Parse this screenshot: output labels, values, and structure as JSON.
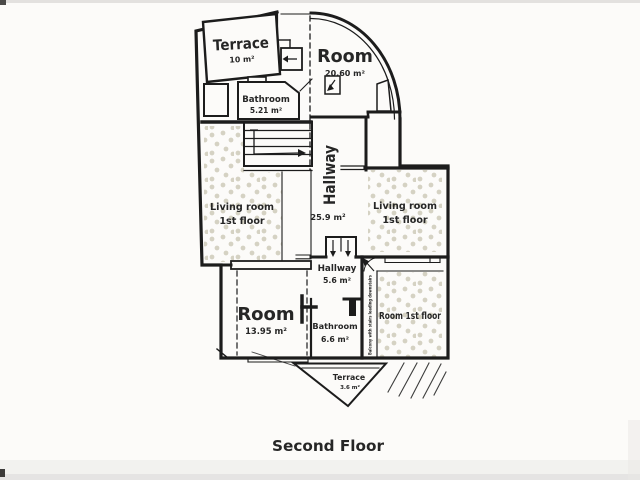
{
  "page": {
    "title": "Second Floor"
  },
  "colors": {
    "wall": "#1c1c1c",
    "dot_fill": "#d5d2c3",
    "paper": "#fcfbf9",
    "text": "#262626"
  },
  "rooms": {
    "terrace_top": {
      "label": "Terrace",
      "area": "10 m²"
    },
    "bathroom_top": {
      "label": "Bathroom",
      "area": "5.21 m²"
    },
    "room_round": {
      "label": "Room",
      "area": "20.60 m²"
    },
    "hallway_main": {
      "label": "Hallway",
      "area": "25.9 m²"
    },
    "living_room_left": {
      "label": "Living room",
      "sublabel": "1st floor"
    },
    "living_room_right": {
      "label": "Living room",
      "sublabel": "1st floor"
    },
    "hallway_lower": {
      "label": "Hallway",
      "area": "5.6 m²"
    },
    "room_lower_left": {
      "label": "Room",
      "area": "13.95 m²"
    },
    "bathroom_lower": {
      "label": "Bathroom",
      "area": "6.6 m²"
    },
    "room_lower_right": {
      "label": "Room 1st floor"
    },
    "terrace_lower": {
      "label": "Terrace",
      "area": "3.6 m²"
    },
    "balcony_note": {
      "label": "Balcony with stairs leading downstairs"
    }
  }
}
